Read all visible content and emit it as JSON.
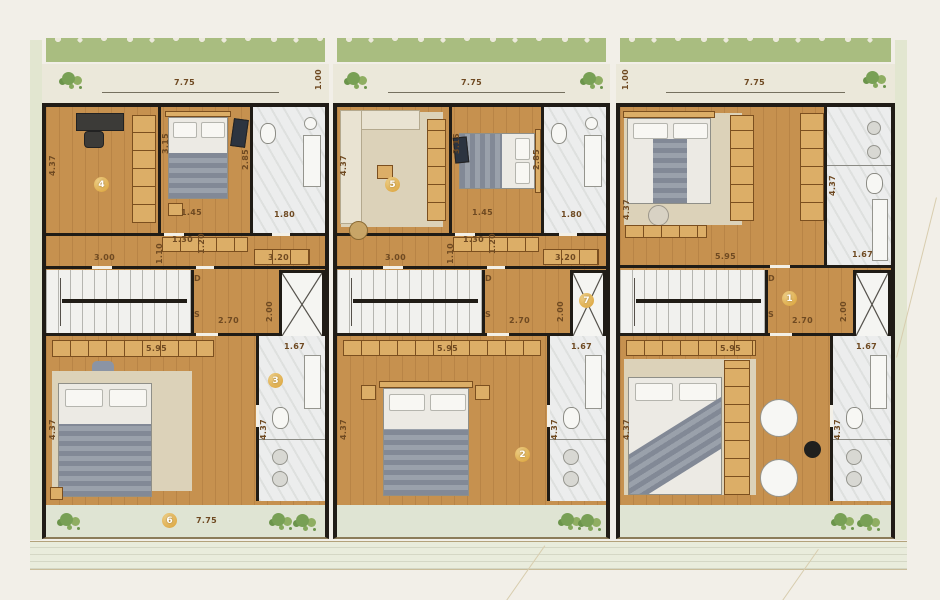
{
  "meta": {
    "kind": "residential-floor-plan",
    "units_count": 3
  },
  "palette": {
    "background": "#f2efe8",
    "wall": "#201c16",
    "wood_floor": "#c6914f",
    "furniture_wood": "#dcae67",
    "marble": "#eceded",
    "hedge_green": "#a9bd80",
    "balcony_green": "#dfe4d3",
    "badge_gold": "#d99f33",
    "label_brown": "#6f4a22"
  },
  "units": [
    {
      "id": "left",
      "badges": {
        "room": "4",
        "bath": "3",
        "balcony": "6"
      },
      "dims": {
        "front": "7.75",
        "side_small": "1.00",
        "upper_left_v": "4.37",
        "mid_wall_v": "3.15",
        "bath_v": "2.85",
        "closet": "1.45",
        "bath_door": "1.80",
        "pass1": "1.30",
        "pass2_v": "1.20",
        "room_w": "3.00",
        "door_v": "1.10",
        "cabinet": "3.20",
        "stair_down": "D",
        "stair_up": "S",
        "hall_len": "2.70",
        "elev_v": "2.00",
        "lower_w": "5.95",
        "lower_left_v": "4.37",
        "lower_bath_w": "1.67",
        "lower_bath_v": "4.37",
        "balcony_w": "7.75"
      }
    },
    {
      "id": "middle",
      "badges": {
        "living": "5",
        "elevator": "7",
        "bedroom": "2"
      },
      "dims": {
        "front": "7.75",
        "upper_left_v": "4.37",
        "mid_wall_v": "3.15",
        "bath_v": "2.85",
        "closet": "1.45",
        "bath_door": "1.80",
        "pass1": "1.30",
        "pass2_v": "1.20",
        "room_w": "3.00",
        "door_v": "1.10",
        "cabinet": "3.20",
        "stair_down": "D",
        "stair_up": "S",
        "hall_len": "2.70",
        "elev_v": "2.00",
        "lower_w": "5.95",
        "lower_left_v": "4.37",
        "lower_bath_w": "1.67",
        "lower_bath_v": "4.37"
      }
    },
    {
      "id": "right",
      "badges": {
        "hall": "1"
      },
      "dims": {
        "front": "7.75",
        "side_small": "1.00",
        "upper_left_v": "4.37",
        "upper_w": "5.95",
        "upper_bath_v": "4.37",
        "upper_bath_w": "1.67",
        "stair_down": "D",
        "stair_up": "S",
        "hall_len": "2.70",
        "elev_v": "2.00",
        "lower_w": "5.95",
        "lower_left_v": "4.37",
        "lower_bath_w": "1.67",
        "lower_bath_v": "4.37"
      }
    }
  ]
}
